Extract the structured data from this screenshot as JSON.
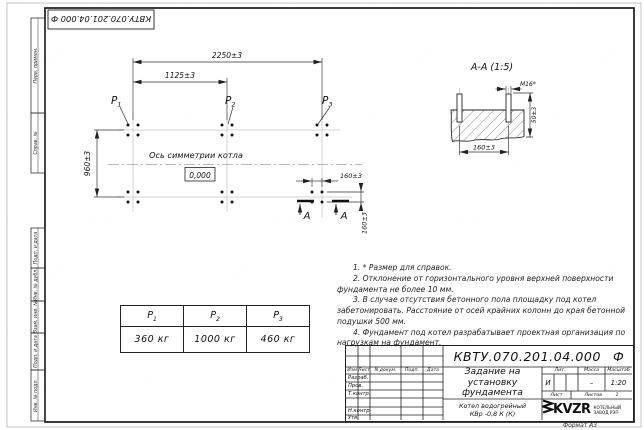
{
  "doc": {
    "number": "КВТУ.070.201.04.000",
    "suffix": "Ф",
    "full": "КВТУ.070.201.04.000  Ф"
  },
  "frame": {
    "top_labels": [
      "Перв. примен.",
      "Справ. №"
    ],
    "bottom_labels": [
      "Подп. и дата",
      "Инв. № дубл.",
      "Взам. инв. №",
      "Подп. и дата",
      "Инв. № подл."
    ],
    "format_label": "Формат А3"
  },
  "plan": {
    "dim_total": "2250±3",
    "dim_half": "1125±3",
    "dim_depth": "960±3",
    "dim_bolt_h": "160±3",
    "dim_bolt_v": "160±3",
    "axis_label": "Ось симметрии котла",
    "level": "0,000",
    "p_base": "P",
    "p_subs": [
      "1",
      "2",
      "3"
    ],
    "section_letter": "А"
  },
  "section": {
    "title": "А-А (1:5)",
    "bolt": "М16*",
    "dim_h": "50±3",
    "dim_w": "160±3"
  },
  "loads_table": {
    "headers": [
      {
        "base": "P",
        "sub": "1"
      },
      {
        "base": "P",
        "sub": "2"
      },
      {
        "base": "P",
        "sub": "3"
      }
    ],
    "values": [
      "360 кг",
      "1000 кг",
      "460 кг"
    ]
  },
  "notes": [
    "1. * Размер для справок.",
    "2. Отклонение от горизонтального уровня верхней поверхности фундамента не более 10 мм.",
    "3. В случае отсутствия бетонного пола площадку под котел забетонировать. Расстояние от осей крайних колонн до края бетонной подушки 500 мм.",
    "4. Фундамент под котел разрабатывает проектная организация по нагрузкам на фундамент."
  ],
  "title_block": {
    "title_lines": [
      "Задание на",
      "установку",
      "фундамента"
    ],
    "product_lines": [
      "Котел водогрейный",
      "КВр -0,8 К (К)"
    ],
    "lit_header": "Лит.",
    "mass_header": "Масса",
    "scale_header": "Масштаб",
    "lit": "И",
    "mass": "–",
    "scale": "1:20",
    "sheet_label": "Лист",
    "sheets_label": "Листов",
    "sheets_count": "1",
    "header_cols": [
      "Изм",
      "Лист",
      "N докум.",
      "Подп.",
      "Дата"
    ],
    "signature_rows": [
      "Разраб.",
      "Пров.",
      "Т.контр.",
      "Н.контр.",
      "Утв."
    ],
    "company_name": "KVZR",
    "company_desc": [
      "КОТЕЛЬНЫЙ",
      "ЗАВОД РЭП"
    ]
  },
  "watermark": {
    "glyph": "········",
    "color": "#e7ebee"
  }
}
